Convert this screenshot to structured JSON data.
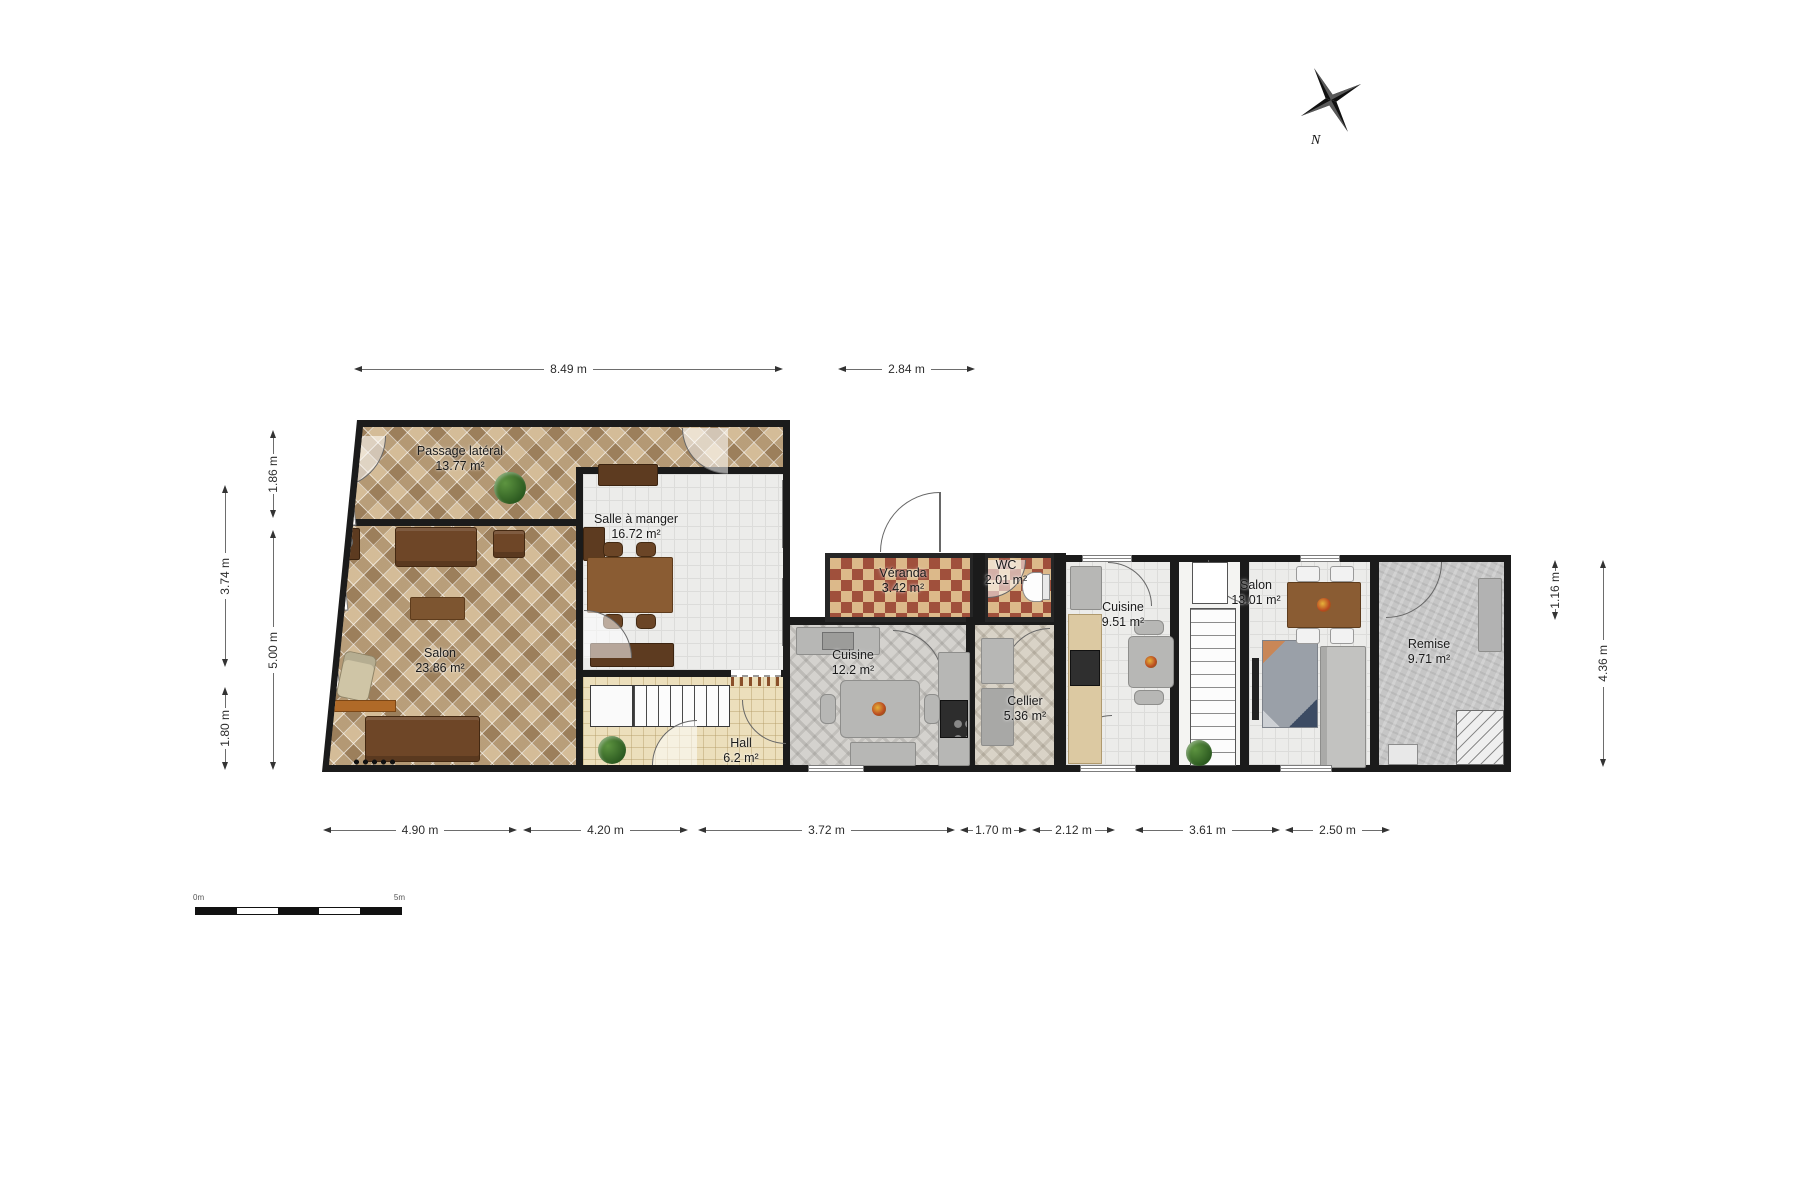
{
  "plan": {
    "rooms": {
      "passage_lateral": {
        "name": "Passage latéral",
        "area": "13.77 m²"
      },
      "salon_left": {
        "name": "Salon",
        "area": "23.86 m²"
      },
      "salle_a_manger": {
        "name": "Salle à manger",
        "area": "16.72 m²"
      },
      "hall": {
        "name": "Hall",
        "area": "6.2 m²"
      },
      "cuisine_left": {
        "name": "Cuisine",
        "area": "12.2 m²"
      },
      "veranda": {
        "name": "Véranda",
        "area": "3.42 m²"
      },
      "wc": {
        "name": "WC",
        "area": "2.01 m²"
      },
      "cellier": {
        "name": "Cellier",
        "area": "5.36 m²"
      },
      "cuisine_right": {
        "name": "Cuisine",
        "area": "9.51 m²"
      },
      "salon_right": {
        "name": "Salon",
        "area": "13.01 m²"
      },
      "remise": {
        "name": "Remise",
        "area": "9.71 m²"
      }
    },
    "dimensions": {
      "top": [
        "8.49 m",
        "2.84 m"
      ],
      "bottom": [
        "4.90 m",
        "4.20 m",
        "3.72 m",
        "1.70 m",
        "2.12 m",
        "3.61 m",
        "2.50 m"
      ],
      "left_outer": [
        "3.74 m",
        "1.80 m"
      ],
      "left_inner": [
        "1.86 m",
        "5.00 m"
      ],
      "right": [
        "1.16 m",
        "4.36 m"
      ]
    },
    "compass": {
      "label": "N"
    },
    "scale_bar": {
      "start": "0m",
      "end": "5m"
    },
    "colors": {
      "wall": "#1b1b1b",
      "checker_red": "#a0503c",
      "checker_tan": "#dcb98a",
      "accent_wood": "#8a5c33"
    }
  }
}
